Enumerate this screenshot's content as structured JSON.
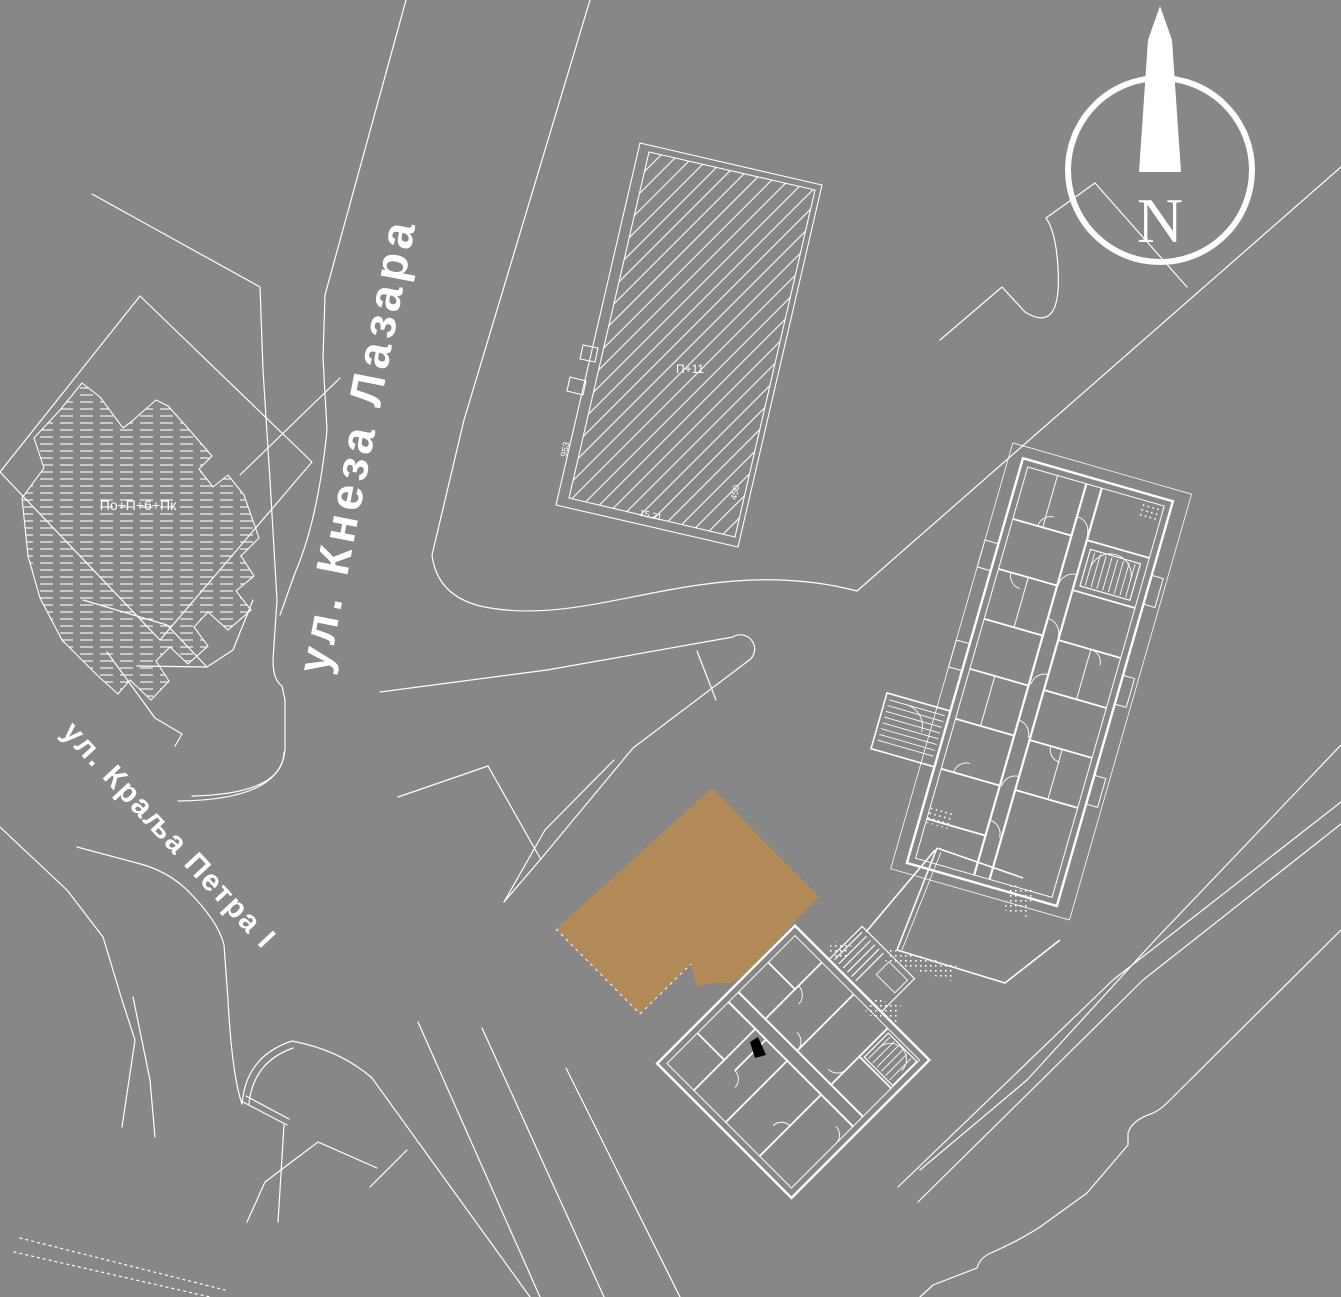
{
  "colors": {
    "background": "#878787",
    "linework": "#ffffff",
    "parcel_highlight": "#b18a58",
    "mark": "#000000"
  },
  "labels": {
    "street_main": "ул. Кнеза Лазара",
    "street_secondary": "ул. Краља Петра I",
    "building_hatched_tall": "П+11",
    "building_hatched_west": "По+П+6+Пк",
    "compass_north": "N",
    "dim_west": "953",
    "dim_south": "15,21",
    "dim_east": "450"
  }
}
